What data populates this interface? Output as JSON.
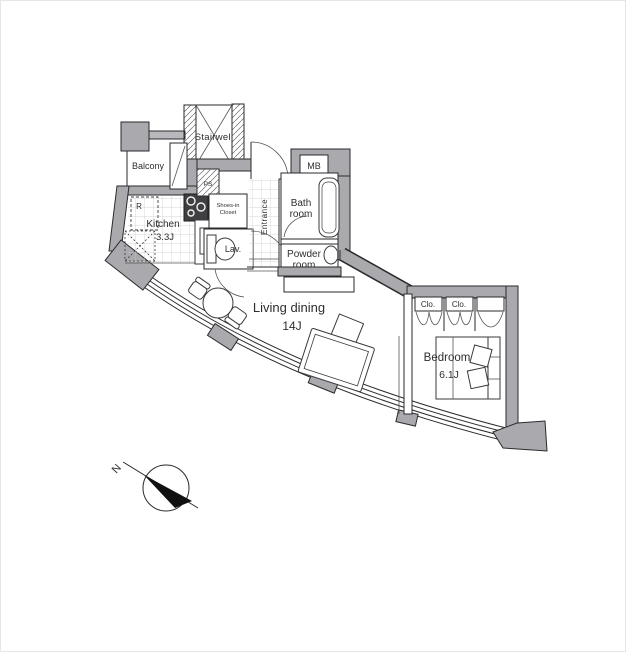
{
  "document": {
    "type": "apartment-floor-plan",
    "background": "#ffffff"
  },
  "colors": {
    "wall_fill": "#a9a9ae",
    "outline": "#2a2a2c",
    "tile_line": "#c9c9cc",
    "stove_fill": "#3f3f42",
    "text": "#2e2e30"
  },
  "labels": {
    "stairwell": "Stairwell",
    "balcony": "Balcony",
    "ps": "PS",
    "mb": "MB",
    "fridge": "R",
    "kitchen_name": "Kitchen",
    "kitchen_size": "3.3J",
    "shoes_line1": "Shoes-in",
    "shoes_line2": "Closet",
    "entrance": "Entrance",
    "bath_line1": "Bath",
    "bath_line2": "room",
    "powder_line1": "Powder",
    "powder_line2": "room",
    "lav": "Lav.",
    "living_name": "Living dining",
    "living_size": "14J",
    "bedroom_name": "Bedroom",
    "bedroom_size": "6.1J",
    "closet1": "Clo.",
    "closet2": "Clo.",
    "compass_north": "N"
  },
  "rooms": [
    {
      "name": "Kitchen",
      "size": "3.3J"
    },
    {
      "name": "Living dining",
      "size": "14J"
    },
    {
      "name": "Bedroom",
      "size": "6.1J"
    },
    {
      "name": "Bath room"
    },
    {
      "name": "Powder room"
    },
    {
      "name": "Lav."
    },
    {
      "name": "Balcony"
    },
    {
      "name": "Entrance"
    },
    {
      "name": "Shoes-in Closet"
    },
    {
      "name": "Stairwell"
    }
  ]
}
